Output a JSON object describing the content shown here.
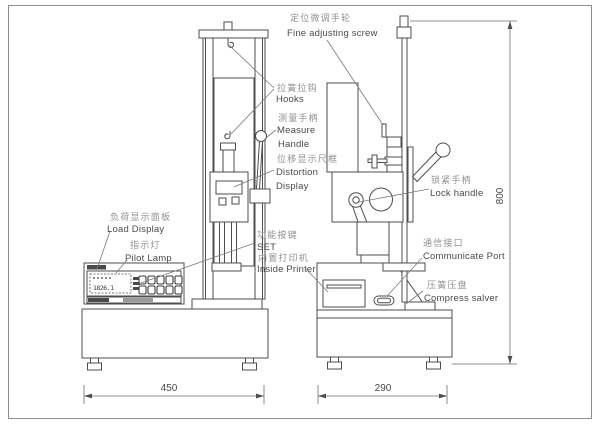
{
  "diagram_title": "Spring tension and compression testing machine outline drawing",
  "labels": {
    "fine_adjusting": {
      "zh": "定位微调手轮",
      "en": "Fine adjusting screw"
    },
    "hooks": {
      "zh": "拉簧拉钩",
      "en": "Hooks"
    },
    "measure_handle": {
      "zh": "测量手柄",
      "en1": "Measure",
      "en2": "Handle"
    },
    "distortion_display": {
      "zh": "位移显示尺框",
      "en1": "Distortion",
      "en2": "Display"
    },
    "load_display": {
      "zh": "负荷显示面板",
      "en": "Load Display"
    },
    "pilot_lamp": {
      "zh": "指示灯",
      "en": "Pilot Lamp"
    },
    "set_key": {
      "zh": "功能按键",
      "en": "SET"
    },
    "inside_printer": {
      "zh": "内置打印机",
      "en": "Inside Printer"
    },
    "lock_handle": {
      "zh": "锁紧手柄",
      "en": "Lock handle"
    },
    "communicate_port": {
      "zh": "通信接口",
      "en": "Communicate Port"
    },
    "compress_salver": {
      "zh": "压簧压盘",
      "en": "Compress salver"
    }
  },
  "dimensions": {
    "left_base_width": "450",
    "right_base_width": "290",
    "column_height": "800"
  },
  "panel": {
    "load_value": "1826.1"
  },
  "colors": {
    "line": "#4d4d4d",
    "label_zh": "#919191",
    "label_en": "#4b4b4b",
    "background": "#ffffff",
    "border": "#8c8c8c"
  }
}
